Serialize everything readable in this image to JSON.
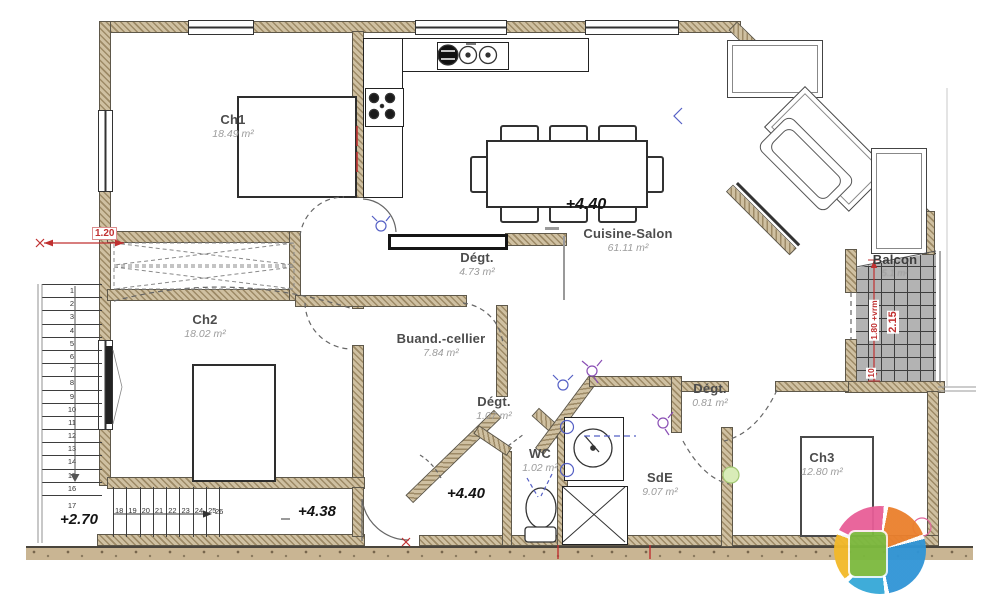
{
  "rooms": {
    "ch1": {
      "name": "Ch1",
      "area": "18.49 m²"
    },
    "ch2": {
      "name": "Ch2",
      "area": "18.02 m²"
    },
    "ch3": {
      "name": "Ch3",
      "area": "12.80 m²"
    },
    "cuisine_salon": {
      "name": "Cuisine-Salon",
      "area": "61.11 m²"
    },
    "degagement_1": {
      "name": "Dégt.",
      "area": "4.73 m²"
    },
    "buanderie": {
      "name": "Buand.-cellier",
      "area": "7.84 m²"
    },
    "degagement_2": {
      "name": "Dégt.",
      "area": "1.07 m²"
    },
    "wc": {
      "name": "WC",
      "area": "1.02 m²"
    },
    "sde": {
      "name": "SdE",
      "area": "9.07 m²"
    },
    "degagement_3": {
      "name": "Dégt.",
      "area": "0.81 m²"
    },
    "balcon": {
      "name": "Balcon",
      "area": "5.1 m²"
    }
  },
  "elevations": {
    "salon": "+4.40",
    "vestibule": "+4.40",
    "couloir": "+4.38",
    "palier": "+2.70"
  },
  "dimensions": {
    "left_opening": "1.20",
    "balcony_rail": "1.80 +vrm",
    "balcony_width": "2.15",
    "balcony_offset": "10"
  },
  "stairs": {
    "upper_steps": [
      "1",
      "2",
      "3",
      "4",
      "5",
      "6",
      "7",
      "8",
      "9",
      "10",
      "11",
      "12",
      "13",
      "14",
      "15",
      "16",
      "17"
    ],
    "lower_steps": [
      "18",
      "19",
      "20",
      "21",
      "22",
      "23",
      "24",
      "25",
      "26"
    ]
  },
  "colors": {
    "wall_fill": "#cfc0a1",
    "wall_hatch": "#9d8a66",
    "dimension_red": "#c03030",
    "electric_blue": "#5560c5",
    "electric_purple": "#8a4fb5",
    "switch_green": "#a2c873",
    "outlet_pink": "#e0679c",
    "balcony_tile": "#b3b3b3",
    "logo_palette": [
      "#35a8d8",
      "#f3b929",
      "#e85e97",
      "#ea7f2c",
      "#2f94d6",
      "#7cb93e"
    ]
  }
}
